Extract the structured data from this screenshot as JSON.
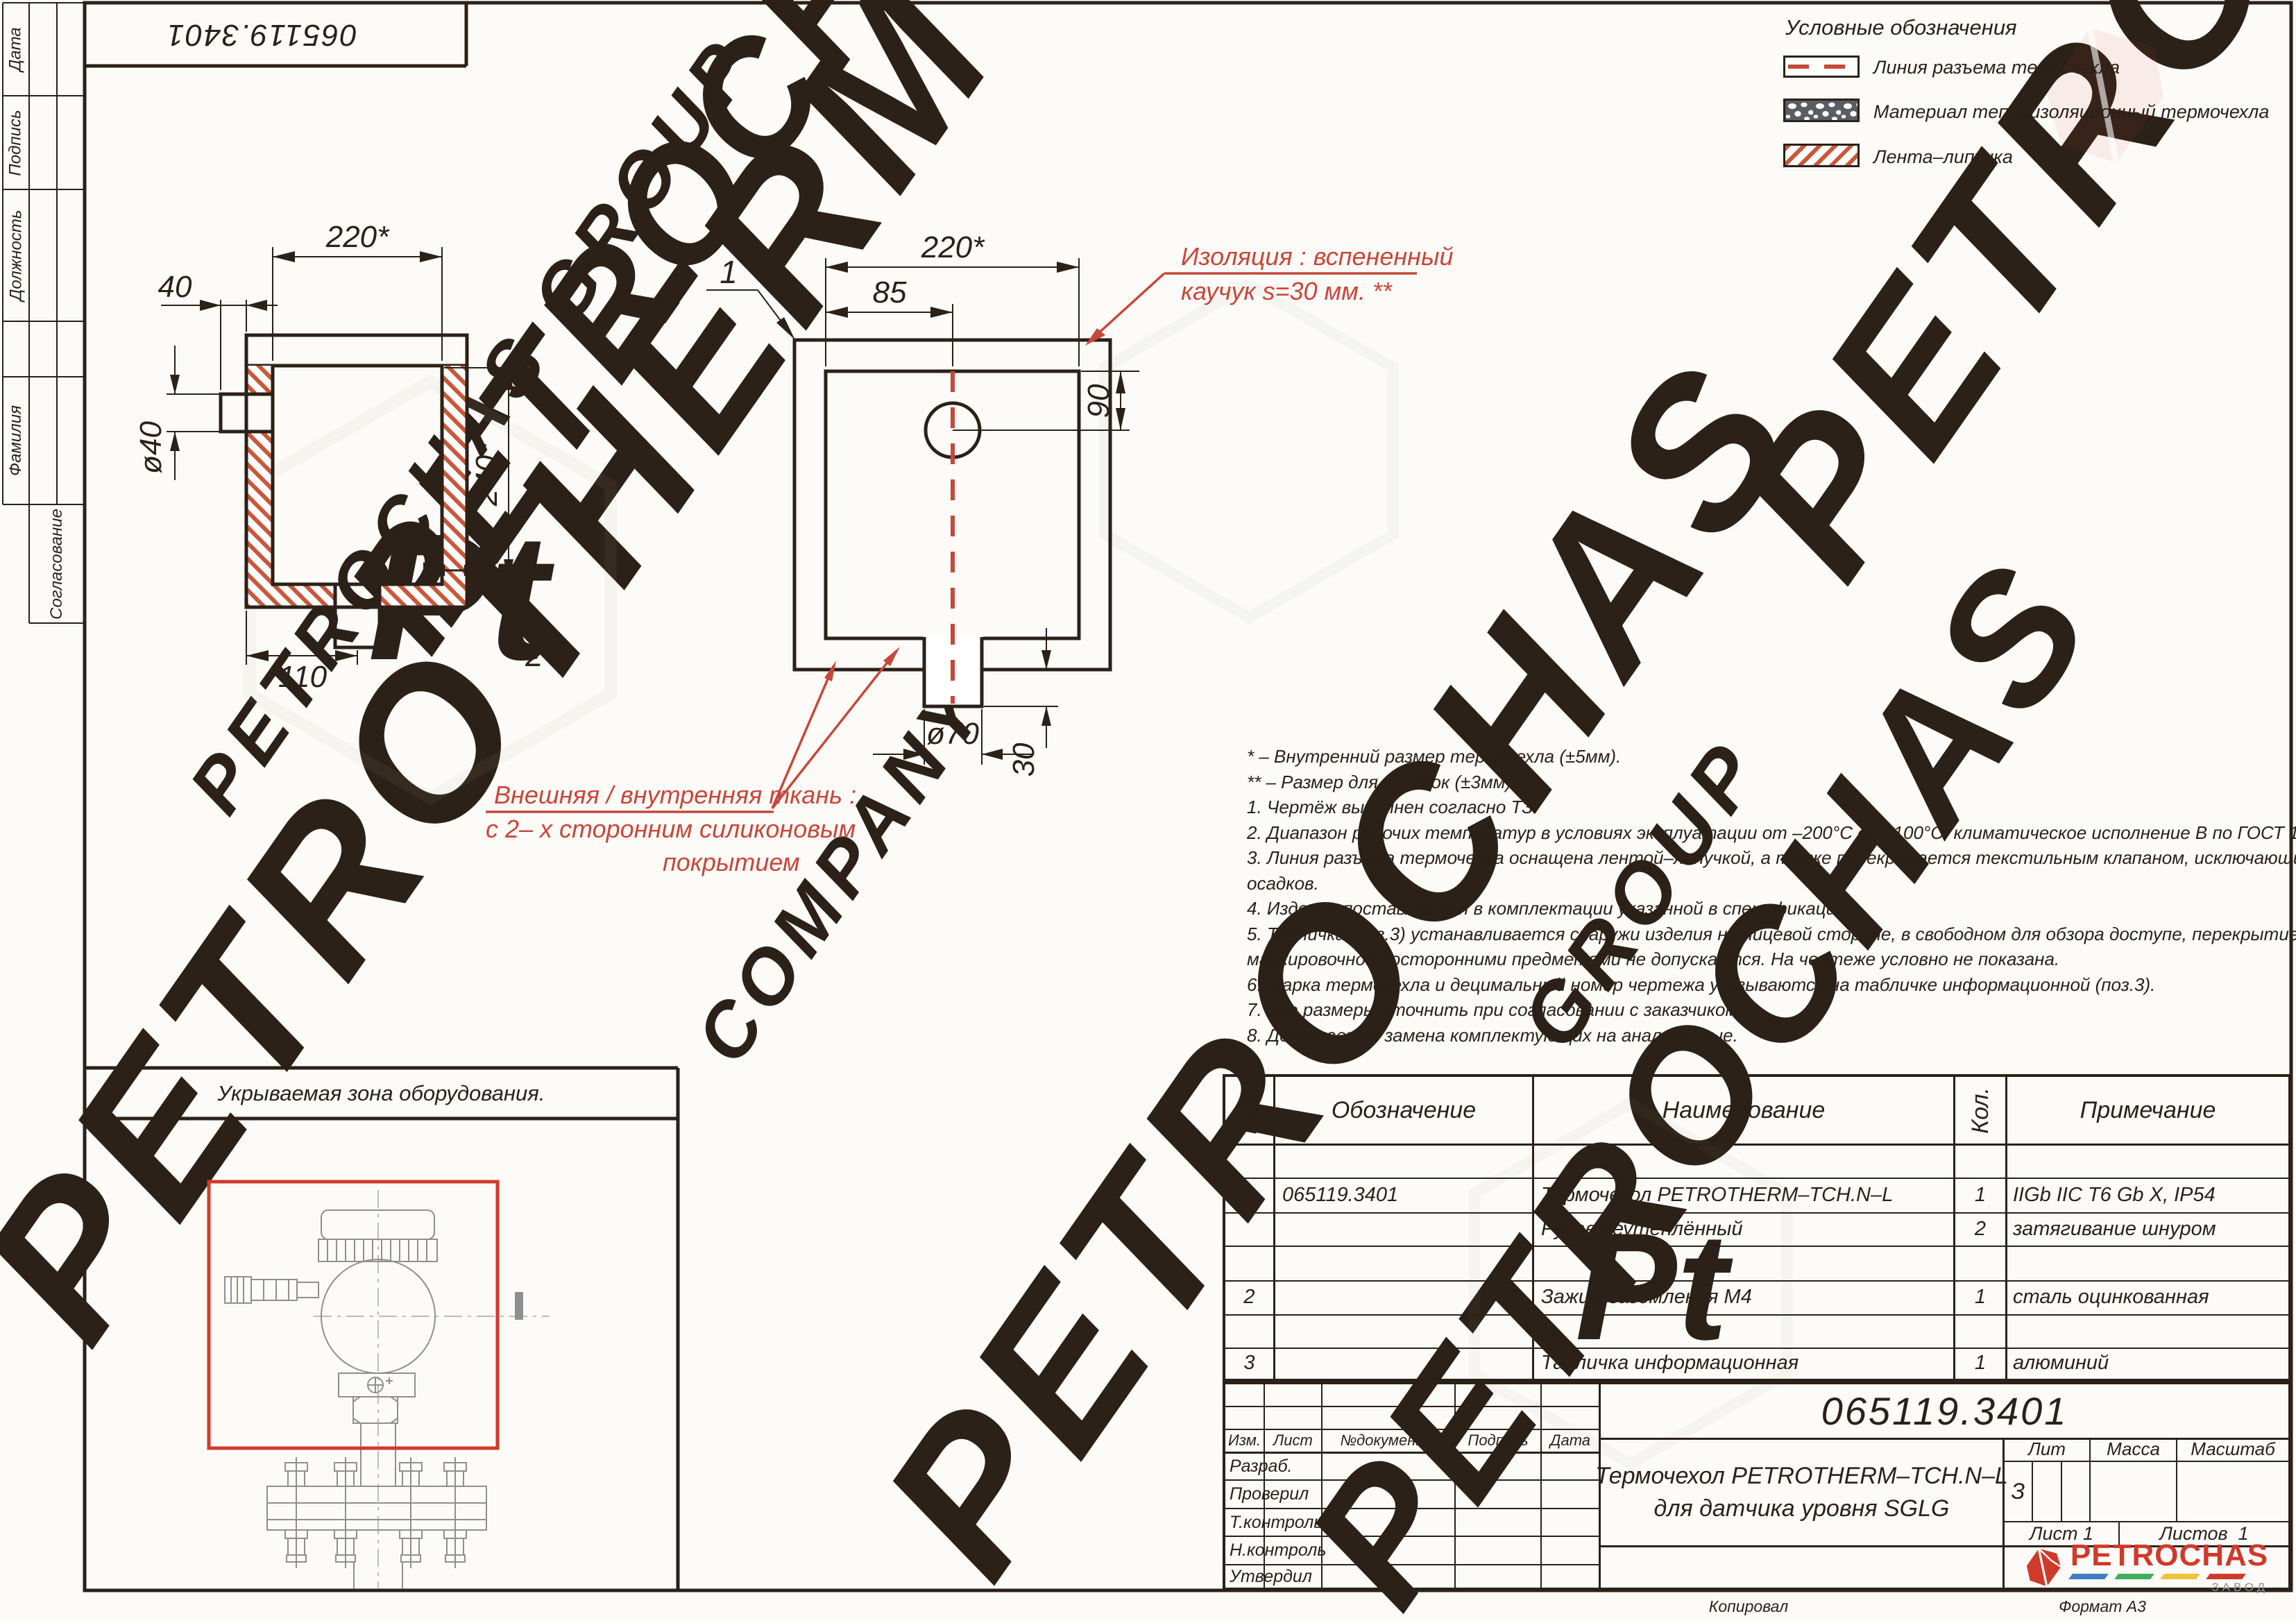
{
  "colors": {
    "line": "#2b2118",
    "hatch": "#c7593a",
    "foam": "#5a5d63",
    "red": "#c7473a",
    "red_box": "#d23b2c",
    "logo_red": "#cf3a2b"
  },
  "stamp_number": "065119.3401",
  "side_labels": {
    "date": "Дата",
    "sign": "Подпись",
    "position": "Должность",
    "surname": "Фамилия",
    "approval": "Согласование"
  },
  "legend": {
    "title": "Условные обозначения",
    "items": [
      {
        "label": "Линия разъема термочехла",
        "swatch": "dashed-line"
      },
      {
        "label": "Материал теплоизоляционный термочехла",
        "swatch": "foam"
      },
      {
        "label": "Лента–липучка",
        "swatch": "hatch"
      }
    ]
  },
  "drawing1": {
    "label_width": "220*",
    "label_offset": "40",
    "label_nozzle": "ø40",
    "label_height": "240*",
    "label_bottom": "110",
    "callout": "2"
  },
  "drawing2": {
    "label_width": "220*",
    "label_85": "85",
    "label_90": "90",
    "label_spout": "ø70",
    "label_30": "30",
    "callout": "1"
  },
  "annotations": {
    "insulation_line1": "Изоляция : вспененный",
    "insulation_line2": "каучук  s=30 мм. **",
    "fabric_line1": "Внешняя / внутренняя ткань :",
    "fabric_line2": "с 2– х сторонним силиконовым",
    "fabric_line3": "покрытием"
  },
  "notes": {
    "lines": [
      "* – Внутренний размер термочехла (±5мм).",
      "** – Размер для справок (±3мм).",
      "1. Чертёж выполнен согласно ТЗ.",
      "2. Диапазон рабочих температур в условиях эксплуатации от –200°С до +100°С, климатическое исполнение В по ГОСТ 15150–69.",
      "3. Линия разъема термочехла оснащена лентой–липучкой, а также перекрывается текстильным клапаном, исключающим попадание",
      "осадков.",
      "4. Изделие поставляется в комплектации указанной в спецификации.",
      "5. Табличка (поз.3) устанавливается снаружи изделия на лицевой стороне, в свободном для обзора доступе, перекрытие таблички",
      "маркировочной посторонними предметами не допускается. На чертеже условно не показана.",
      "6. Марка термочехла и децимальный номер чертежа указываются на табличке информационной (поз.3).",
      "7. Все размеры уточнить при согласовании с заказчиком.",
      "8. Допускается замена комплектующих на аналогичные."
    ]
  },
  "equipment_zone": {
    "title": "Укрываемая зона оборудования."
  },
  "spec_table": {
    "headers": {
      "pos": "Поз.",
      "code": "Обозначение",
      "name": "Наименование",
      "qty": "Кол.",
      "note": "Примечание"
    },
    "row1": {
      "pos": "1",
      "code": "065119.3401",
      "name": "Термочехол PETROTHERM–TCH.N–L",
      "qty": "1",
      "note": "IIGb IIC T6 Gb X, IP54"
    },
    "row2": {
      "name": "Рукав неутеплённый",
      "qty": "2",
      "note": "затягивание шнуром"
    },
    "row3": {
      "pos": "2",
      "name": "Зажим заземления М4",
      "qty": "1",
      "note": "сталь оцинкованная"
    },
    "row4": {
      "pos": "3",
      "name": "Табличка информационная",
      "qty": "1",
      "note": "алюминий"
    }
  },
  "title_block": {
    "doc_number": "065119.3401",
    "cols": {
      "izm": "Изм.",
      "list": "Лист",
      "doc": "№документа",
      "sign": "Подпись",
      "date": "Дата"
    },
    "rows": {
      "dev": "Разраб.",
      "check": "Проверил",
      "tcontrol": "Т.контроль",
      "ncontrol": "Н.контроль",
      "approve": "Утвердил"
    },
    "name_line1": "Термочехол PETROTHERM–TCH.N–L",
    "name_line2": "для датчика уровня SGLG",
    "lit": "Лит",
    "mass": "Масса",
    "scale": "Масштаб",
    "lit_value": "З",
    "sheet": "Лист 1",
    "sheets": "Листов  1"
  },
  "logo": {
    "text": "PETROCHAS",
    "sub": "ЗАВОД"
  },
  "footer": {
    "copied": "Копировал",
    "format": "Формат А3"
  },
  "watermarks": {
    "items": [
      "PETROTHERM",
      "PETROCHAS GROUP",
      "PETROCHAS",
      "COMPANY",
      "PETROCHAS",
      "GROUP",
      "PETROCHAS",
      "PETROCHAS"
    ],
    "pt": "Pt"
  }
}
